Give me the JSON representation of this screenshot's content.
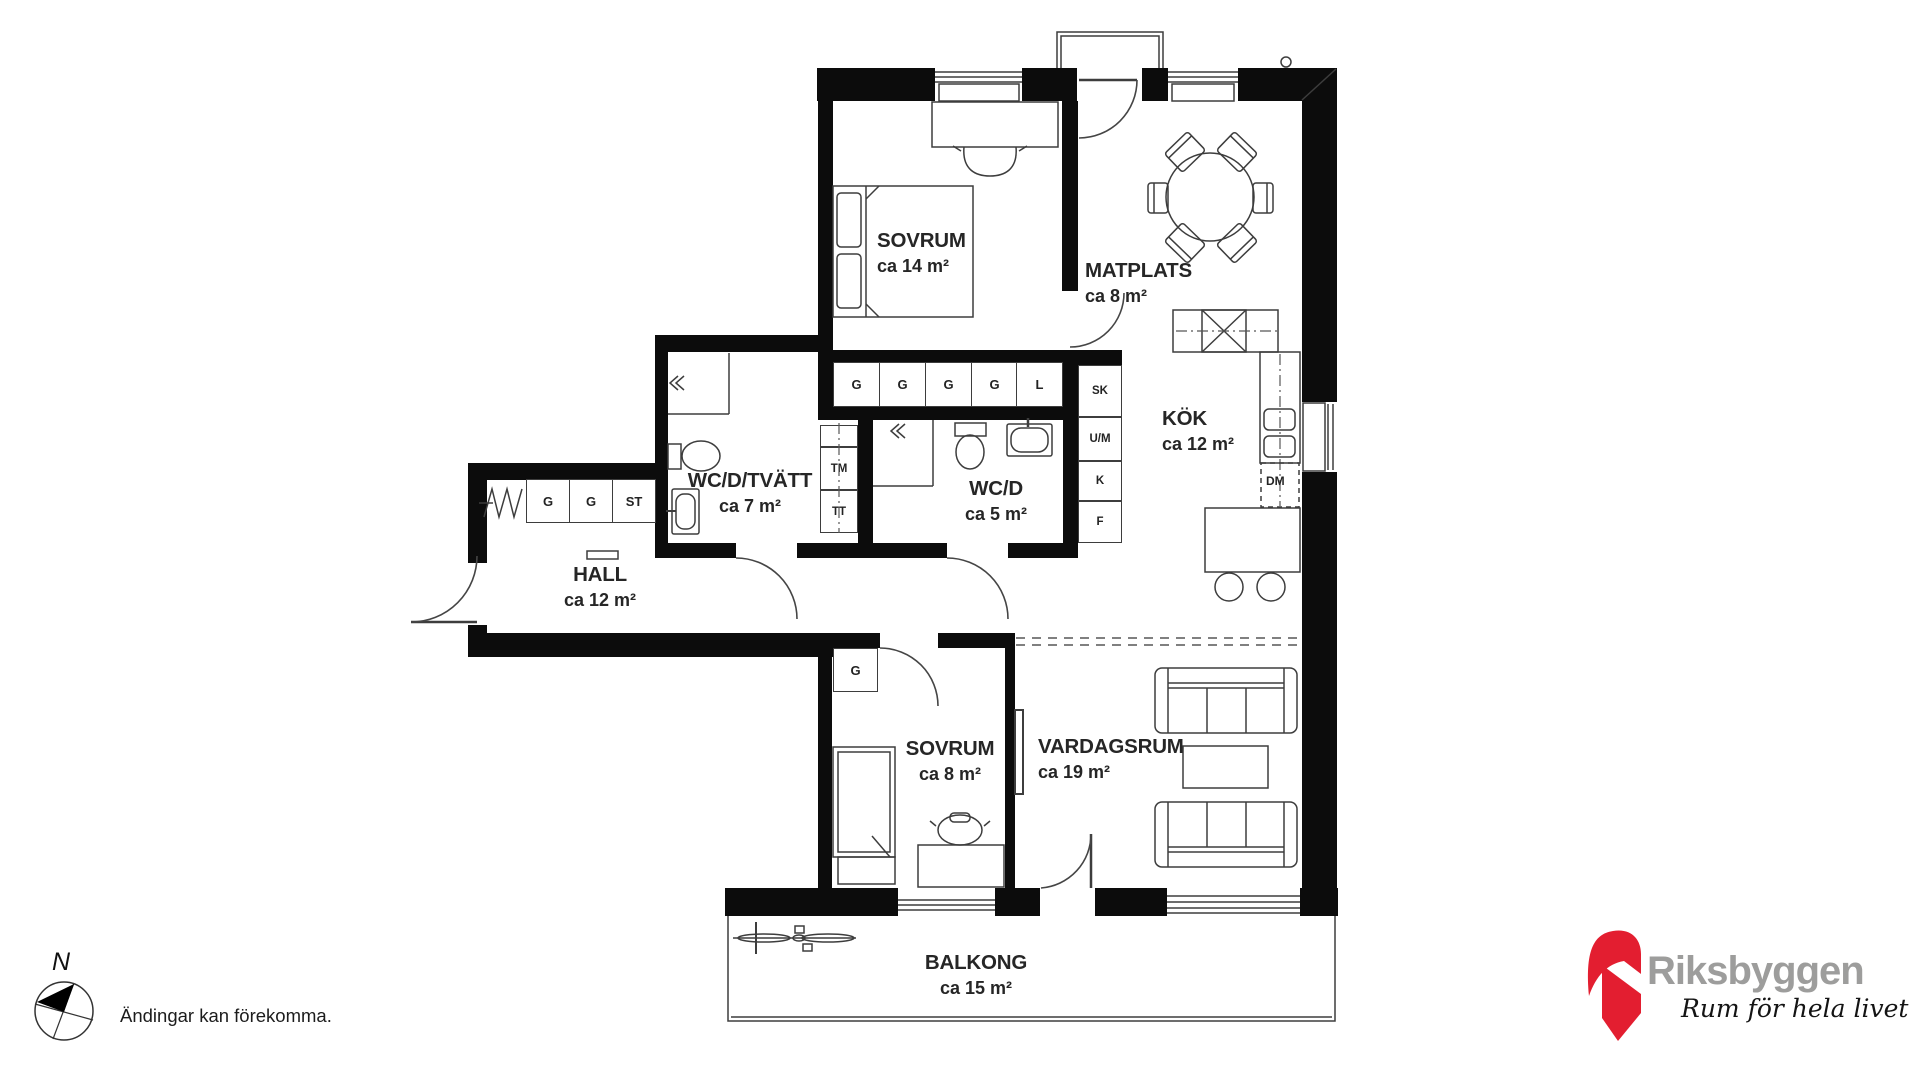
{
  "plan": {
    "rooms": [
      {
        "name": "SOVRUM",
        "area": "ca 14 m²"
      },
      {
        "name": "MATPLATS",
        "area": "ca 8 m²"
      },
      {
        "name": "KÖK",
        "area": "ca 12 m²"
      },
      {
        "name": "WC/D/TVÄTT",
        "area": "ca 7 m²"
      },
      {
        "name": "WC/D",
        "area": "ca 5 m²"
      },
      {
        "name": "HALL",
        "area": "ca 12 m²"
      },
      {
        "name": "SOVRUM",
        "area": "ca 8 m²"
      },
      {
        "name": "VARDAGSRUM",
        "area": "ca 19 m²"
      },
      {
        "name": "BALKONG",
        "area": "ca 15 m²"
      }
    ],
    "closets": {
      "bedroom1": [
        "G",
        "G",
        "G",
        "G",
        "L"
      ],
      "hall": [
        "G",
        "G",
        "ST"
      ],
      "bedroom2": "G"
    },
    "cabinets": [
      "SK",
      "U/M",
      "K",
      "F"
    ],
    "laundry": [
      "TM",
      "TT"
    ],
    "appliances": {
      "dishwasher": "DM"
    },
    "compass_north": "N",
    "disclaimer": "Ändingar kan förekomma."
  },
  "logo": {
    "brand": "Riksbyggen",
    "tagline": "Rum för hela livet",
    "colors": {
      "red": "#e31e30",
      "gray": "#9d9d9c"
    }
  }
}
